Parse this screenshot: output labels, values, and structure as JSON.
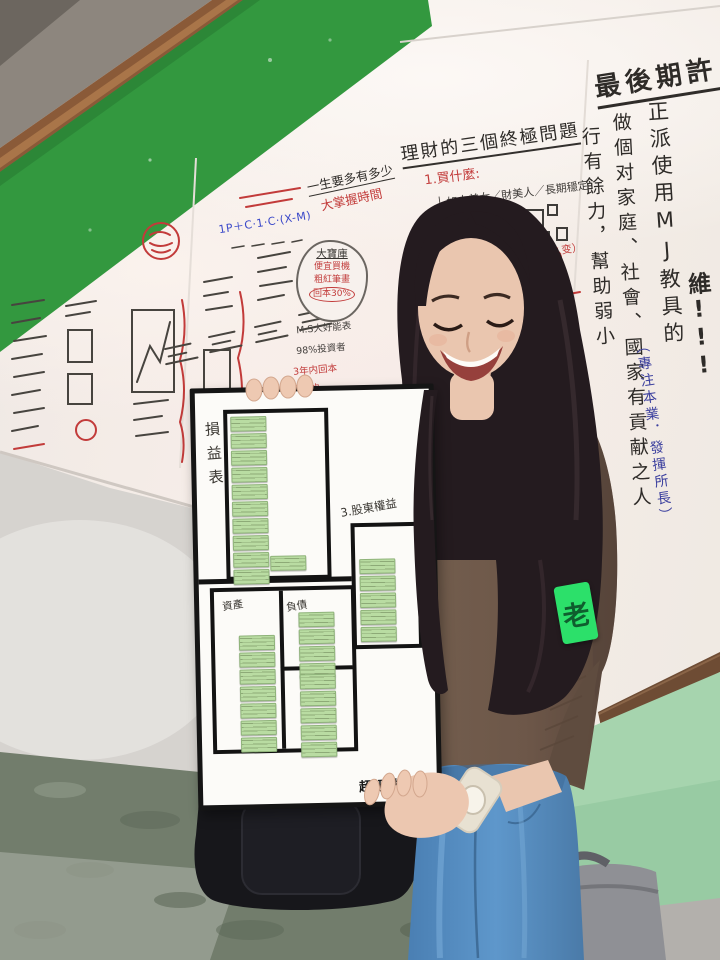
{
  "photo": {
    "right_wall": {
      "headline": "最後期許",
      "col_1": "正派使用MJ教具的",
      "col_2": "做個对家庭、社會、國家有貢献之人",
      "col_3": "行有餘力，幫助弱小",
      "highlight": "財務思維!!!",
      "blue_note": "（專注本業．發揮所長）"
    },
    "center_wall": {
      "title": "理財的三個終極問題",
      "q1": "1.買什麼:",
      "q1_item_1": "├ 如大美女／財美人／長期穩定",
      "q1_item_2": "├ 先求A，再求B",
      "q1_item_3": "└ 看財報＋2堂課",
      "q2": "2.何時買?",
      "q2_note": "做2件事（什么变）",
      "life_question": "一生要多有多少",
      "life_answer": "大掌握時間",
      "bubble_title": "大寶庫",
      "bubble_line_1": "便宜買機",
      "bubble_line_2": "粗紅筆畫",
      "bubble_line_3": "回本30%",
      "note_1": "M.S大好能表",
      "note_2": "98%投資者",
      "note_3": "3年内回本",
      "note_4": "降低的",
      "formula": "1P＋C·1·C·(X-M)"
    },
    "held_board": {
      "label_income": "損益表",
      "label_equity": "3.股東權益",
      "label_assets": "資產",
      "label_liabilities": "負債",
      "logo": "超級數字力",
      "note_groups": {
        "income": 10,
        "income_foot": 1,
        "equity": 5,
        "assets": 7,
        "liabilities": 4,
        "equity_lower": 5
      }
    },
    "armband_text": "老",
    "colors": {
      "band_green": "#33983f",
      "wainscot_green": "#a6d4ae",
      "note_green": "#b9dca2",
      "armband_green": "#2ce06a",
      "sweater_brown": "#6d5749",
      "jeans_blue": "#5e97cb"
    }
  }
}
